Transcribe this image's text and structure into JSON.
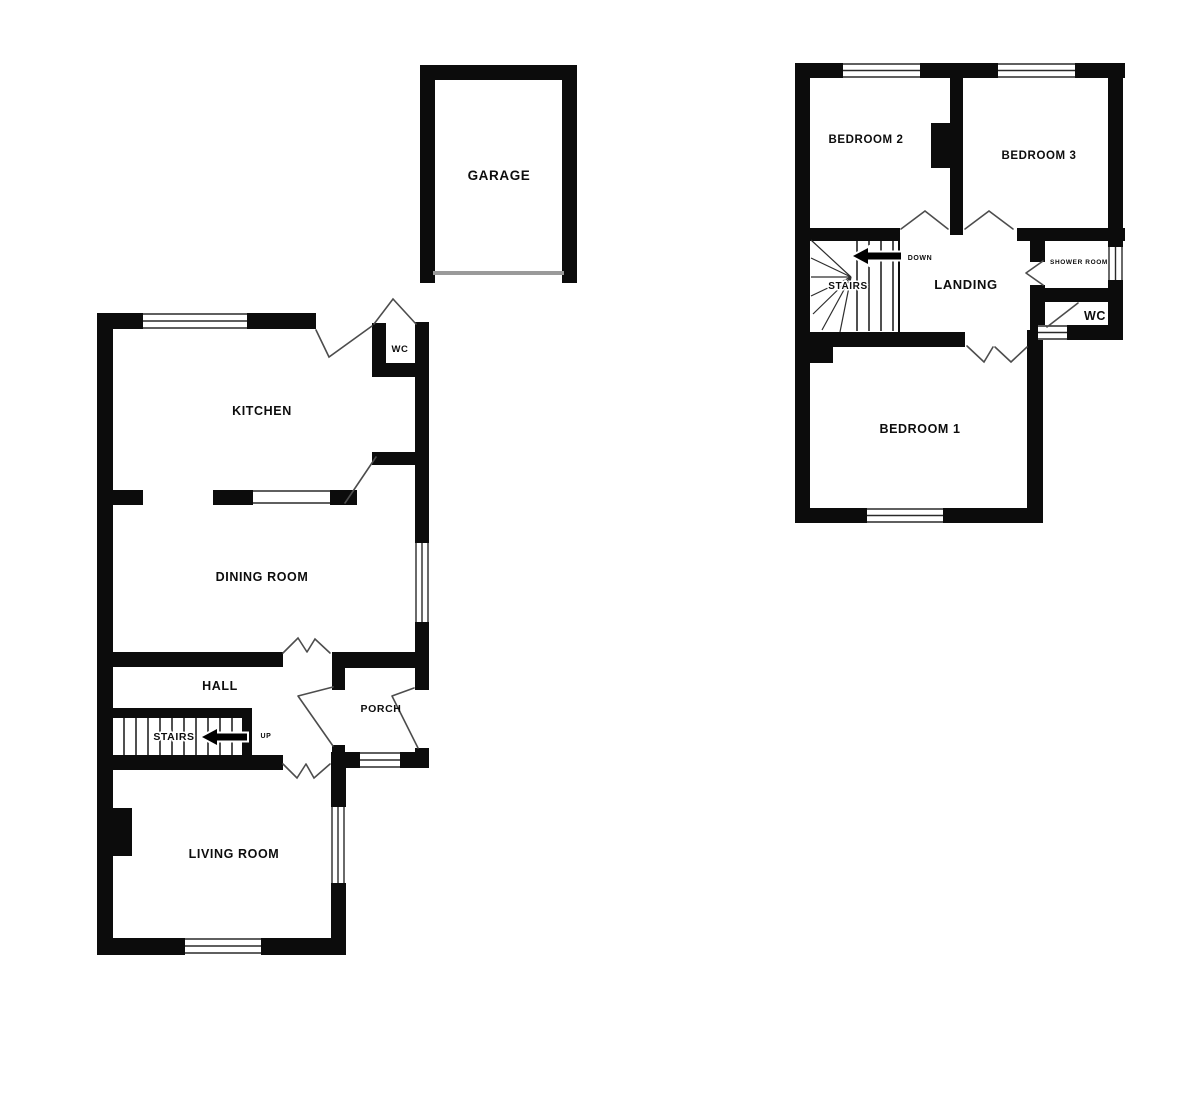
{
  "plan": {
    "garage": {
      "label": "GARAGE"
    },
    "ground_floor": {
      "kitchen": "KITCHEN",
      "wc": "WC",
      "dining_room": "DINING ROOM",
      "hall": "HALL",
      "stairs": "STAIRS",
      "up": "UP",
      "porch": "PORCH",
      "living_room": "LIVING ROOM"
    },
    "first_floor": {
      "bedroom2": "BEDROOM 2",
      "bedroom3": "BEDROOM 3",
      "stairs": "STAIRS",
      "down": "DOWN",
      "landing": "LANDING",
      "shower_room": "SHOWER ROOM",
      "wc": "WC",
      "bedroom1": "BEDROOM 1"
    },
    "colors": {
      "wall": "#0c0c0c",
      "door_line": "#4d4d4d",
      "garage_door": "#9a9a9a",
      "background": "#ffffff"
    }
  }
}
